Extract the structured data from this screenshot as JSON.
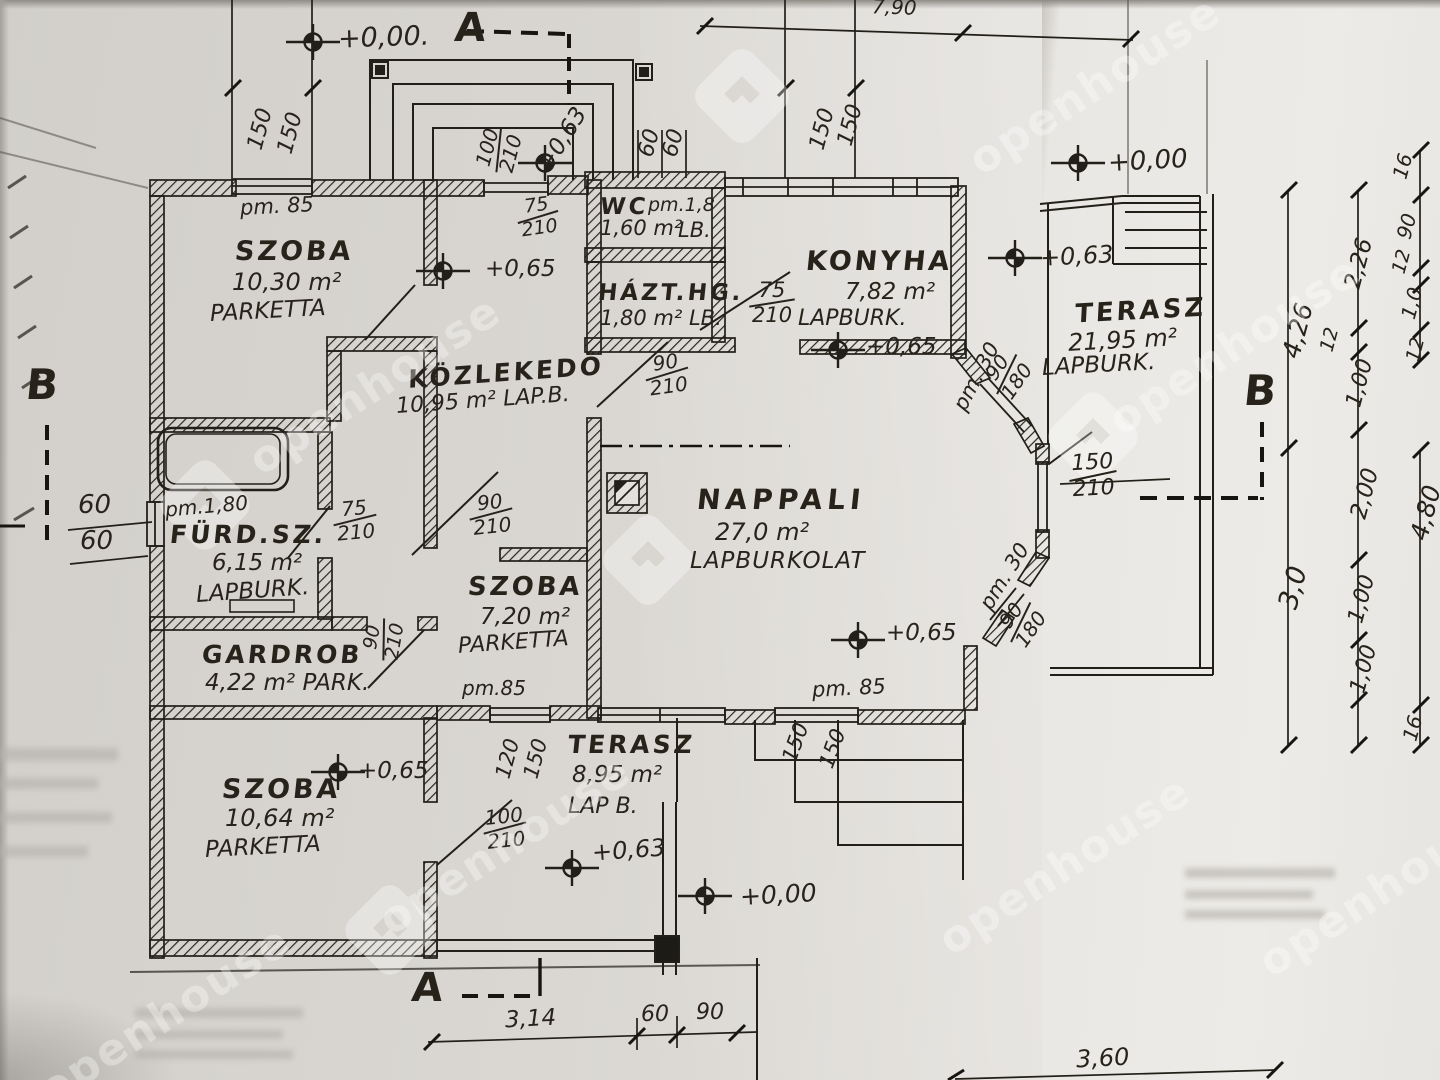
{
  "watermark": {
    "text": "openhouse"
  },
  "sections": {
    "a": "A",
    "b": "B"
  },
  "levels": {
    "v000": "+0,00",
    "v000dot": "+0,00.",
    "v063": "+0,63",
    "v065": "+0,65"
  },
  "pm": {
    "p85": "pm. 85",
    "p85b": "pm.85",
    "p18": "pm.1,8",
    "p180": "pm.1,80",
    "p30": "pm. 30"
  },
  "rooms": {
    "szoba1": {
      "name": "SZOBA",
      "area": "10,30 m²",
      "floor": "PARKETTA"
    },
    "wc": {
      "name": "WC",
      "area": "1,60 m²",
      "floor": "LB."
    },
    "hazt": {
      "name": "HÁZT.HG.",
      "line2": "1,80 m² LB."
    },
    "konyha": {
      "name": "KONYHA",
      "area": "7,82 m²",
      "floor": "LAPBURK."
    },
    "terasz1": {
      "name": "TERASZ",
      "area": "21,95 m²",
      "floor": "LAPBURK."
    },
    "kozlekedo": {
      "name": "KÖZLEKEDÖ",
      "line2": "10,95 m² LAP.B."
    },
    "nappali": {
      "name": "NAPPALI",
      "area": "27,0 m²",
      "floor": "LAPBURKOLAT"
    },
    "furdo": {
      "name": "FÜRD.SZ.",
      "area": "6,15 m²",
      "floor": "LAPBURK."
    },
    "gardrob": {
      "name": "GARDROB",
      "line2": "4,22 m² PARK."
    },
    "szoba2": {
      "name": "SZOBA",
      "area": "7,20 m²",
      "floor": "PARKETTA"
    },
    "szoba3": {
      "name": "SZOBA",
      "area": "10,64 m²",
      "floor": "PARKETTA"
    },
    "terasz2": {
      "name": "TERASZ",
      "area": "8,95 m²",
      "floor": "LAP B."
    }
  },
  "dims": {
    "n60": "60",
    "n75": "75",
    "n90": "90",
    "n100": "100",
    "n120": "120",
    "n150": "150",
    "n180": "180",
    "n210": "210",
    "n12": "12",
    "n16": "16",
    "n10": "1,0",
    "m226": "2,26",
    "m426": "4,26",
    "m100": "1,00",
    "m200": "2,00",
    "m300": "3,0",
    "m480": "4,80",
    "m790": "7,90",
    "m314": "3,14",
    "m360": "3,60"
  }
}
